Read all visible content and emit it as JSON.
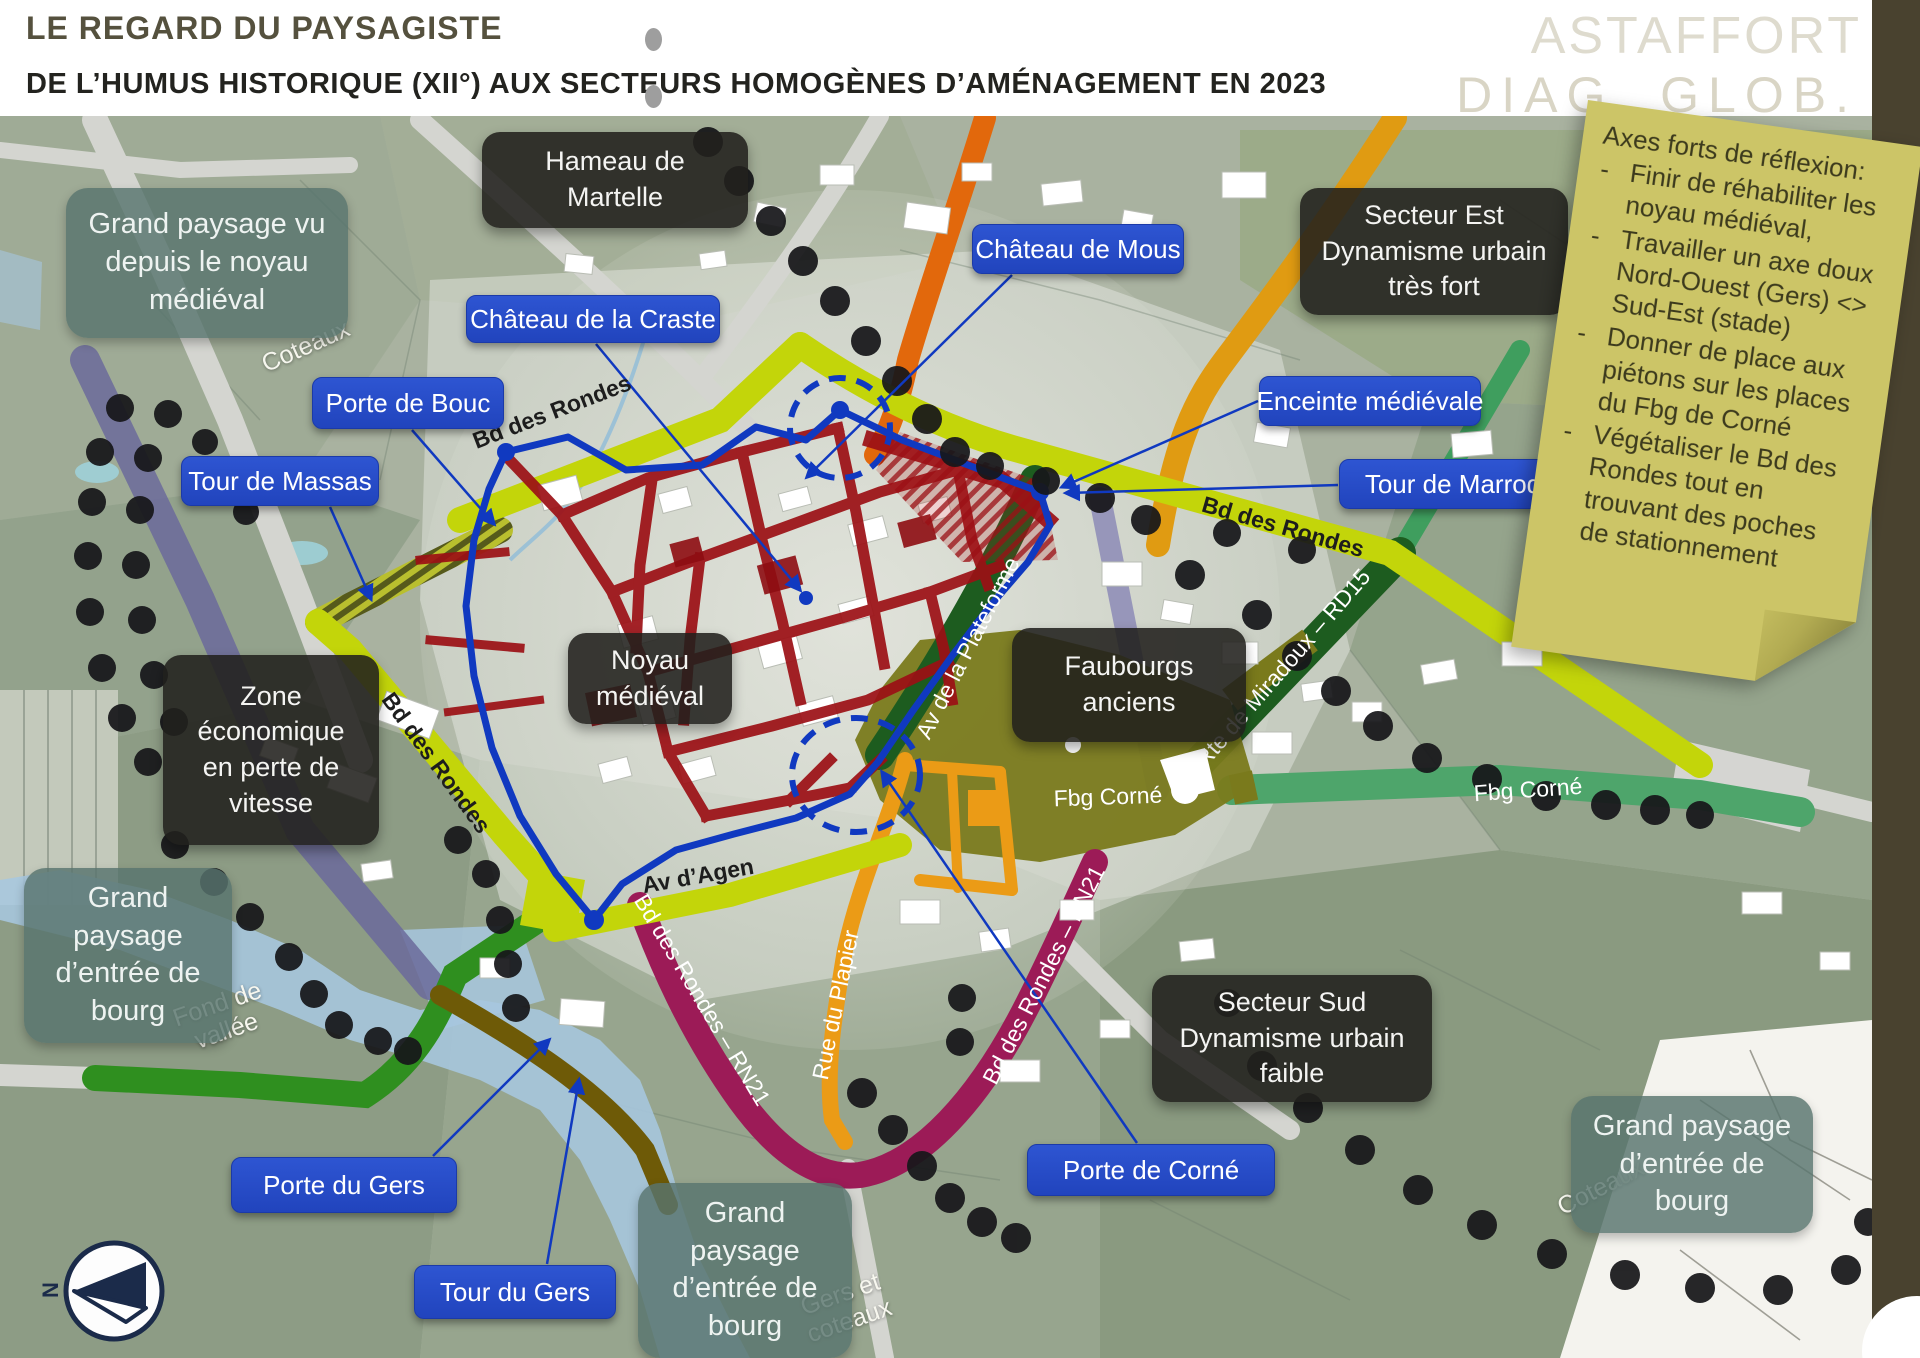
{
  "header": {
    "title": "LE REGARD DU PAYSAGISTE",
    "subtitle": "DE L’HUMUS HISTORIQUE (XII°) AUX SECTEURS HOMOGÈNES D’AMÉNAGEMENT EN 2023",
    "watermark_top": "ASTAFFORT",
    "watermark_bottom": "DIAG. GLOB."
  },
  "note": {
    "title": "Axes forts de réflexion:",
    "items": [
      "Finir de réhabiliter les noyau médiéval,",
      "Travailler un axe doux Nord-Ouest (Gers) <> Sud-Est (stade)",
      "Donner de place aux piétons sur les places du Fbg de Corné",
      "Végétaliser le Bd des Rondes tout en trouvant des poches de stationnement"
    ]
  },
  "sectors": {
    "hameau": "Hameau de\nMartelle",
    "secteur_est": "Secteur Est\nDynamisme urbain\ntrès fort",
    "zone_eco": "Zone\néconomique\nen perte de\nvitesse",
    "noyau": "Noyau\nmédiéval",
    "faubourgs": "Faubourgs\nanciens",
    "secteur_sud": "Secteur Sud\nDynamisme urbain\nfaible"
  },
  "landscape": {
    "nw": "Grand paysage vu\ndepuis le noyau\nmédiéval",
    "west": "Grand\npaysage\nd’entrée de\nbourg",
    "south": "Grand\npaysage\nd’entrée de\nbourg",
    "southeast": "Grand paysage\nd’entrée de\nbourg"
  },
  "poi": {
    "chateau_mous": "Château de Mous",
    "chateau_craste": "Château de la Craste",
    "porte_bouc": "Porte de Bouc",
    "tour_massas": "Tour de Massas",
    "enceinte": "Enceinte médiévale",
    "tour_marroq": "Tour de Marroq",
    "porte_gers": "Porte du Gers",
    "tour_gers": "Tour du Gers",
    "porte_corne": "Porte de Corné"
  },
  "roads": {
    "bd_rondes": "Bd des Rondes",
    "av_agen": "Av d’Agen",
    "plateforme": "Av de la Plateforme",
    "miradoux": "Rte de Miradoux – RD15",
    "fbg_corne": "Fbg Corné",
    "rn21": "Bd des Rondes – RN21",
    "plapier": "Rue du Plapier"
  },
  "terrain": {
    "coteaux": "Coteaux",
    "fond_vallee": "Fond de\nvallée",
    "gers_coteaux": "Gers et\ncoteaux"
  },
  "compass": {
    "north": "N"
  },
  "colors": {
    "ring_road": "#c3d50a",
    "plateforme_road": "#1d5c1f",
    "miradoux_road": "#1d5c1f",
    "fbg_corne_green": "#4ea56b",
    "fbg_corne_olive": "#7a7a1c",
    "rn21_road": "#9c1b57",
    "rue_plapier": "#eb9b16",
    "orange_road": "#e2680c",
    "enceinte_line": "#1039c0",
    "medieval_streets": "#9c1015",
    "poi_box": "#2a4ecb",
    "sector_box": "#21201d",
    "landscape_box": "#58756e",
    "note_bg": "#ccc567",
    "side_bar": "#49422f"
  }
}
